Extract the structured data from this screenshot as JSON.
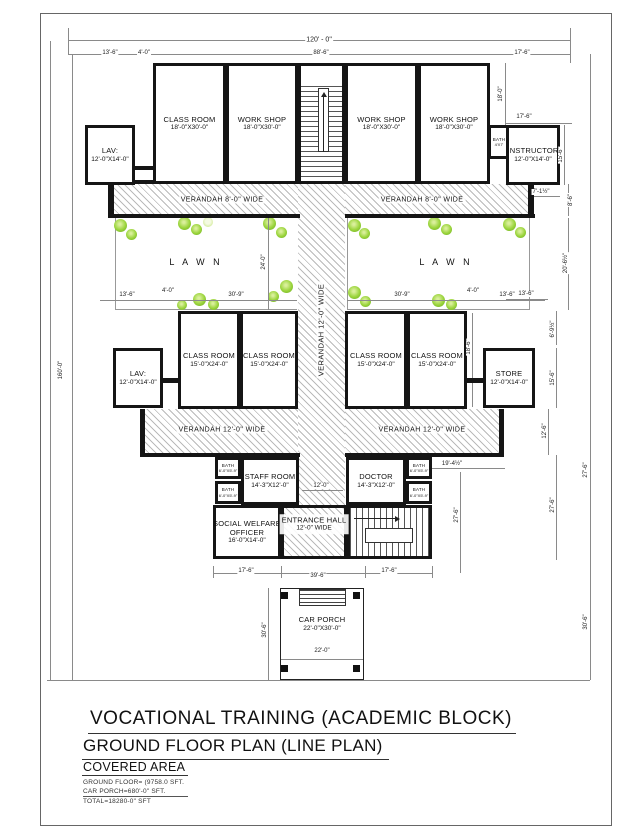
{
  "sheet": {
    "title_line1": "VOCATIONAL TRAINING   (ACADEMIC BLOCK)",
    "title_line2": "GROUND FLOOR PLAN   (LINE PLAN)",
    "covered_area": {
      "heading": "COVERED AREA",
      "line1": "GROUND FLOOR= (9758.0 SFT.",
      "line2": "CAR PORCH=680'-0\" SFT.",
      "line3": "TOTAL=18280-0\" SFT"
    }
  },
  "rooms": {
    "lav_top": {
      "name": "LAV:",
      "size": "12'-0\"X14'-0\""
    },
    "class_top": {
      "name": "CLASS ROOM",
      "size": "18'-0\"X30'-0\""
    },
    "workshop1": {
      "name": "WORK SHOP",
      "size": "18'-0\"X30'-0\""
    },
    "workshop2": {
      "name": "WORK SHOP",
      "size": "18'-0\"X30'-0\""
    },
    "workshop3": {
      "name": "WORK SHOP",
      "size": "18'-0\"X30'-0\""
    },
    "bath_top": {
      "name": "BATH",
      "size": "4'X7'"
    },
    "instructor": {
      "name": "INSTRUCTOR",
      "size": "12'-0\"X14'-0\""
    },
    "lav_mid": {
      "name": "LAV:",
      "size": "12'-0\"X14'-0\""
    },
    "class_mid1": {
      "name": "CLASS ROOM",
      "size": "15'-0\"X24'-0\""
    },
    "class_mid2": {
      "name": "CLASS ROOM",
      "size": "15'-0\"X24'-0\""
    },
    "class_mid3": {
      "name": "CLASS ROOM",
      "size": "15'-0\"X24'-0\""
    },
    "class_mid4": {
      "name": "CLASS ROOM",
      "size": "15'-0\"X24'-0\""
    },
    "store": {
      "name": "STORE",
      "size": "12'-0\"X14'-0\""
    },
    "bath_small": {
      "name": "BATH",
      "size": "6'-0\"X5'-9\""
    },
    "staff": {
      "name": "STAFF ROOM",
      "size": "14'-3\"X12'-0\""
    },
    "doctor": {
      "name": "DOCTOR",
      "size": "14'-3\"X12'-0\""
    },
    "social": {
      "name": "SOCIAL WELFARE",
      "name2": "OFFICER",
      "size": "16'-0\"X14'-0\""
    },
    "entrance": {
      "name": "ENTRANCE HALL",
      "size": "12'-0\" WIDE"
    },
    "car_porch": {
      "name": "CAR PORCH",
      "size": "22'-0\"X30'-0\""
    }
  },
  "areas": {
    "lawn": "L A W N",
    "verandah8": "VERANDAH 8'-0\" WIDE",
    "verandah12": "VERANDAH 12'-0\" WIDE"
  },
  "dims": {
    "overall_width": "120' - 0\"",
    "top_13_6": "13'-6\"",
    "top_4_0": "4'-0\"",
    "top_88_6": "88'-6\"",
    "top_17_6": "17'-6\"",
    "left_height": "160'-0\"",
    "right_18_0": "18'-0\"",
    "instr_17_6": "17'-6\"",
    "instr_15_6": "15'-6\"",
    "r_7_1": "7'-1½\"",
    "r_8_6": "8'-6\"",
    "r_20_6": "20'-6½\"",
    "r_13_6": "13'-6\"",
    "lawn_24": "24'-0\"",
    "lawnl_13_6": "13'-6\"",
    "lawnl_4_0": "4'-0\"",
    "lawnl_30_9": "30'-9\"",
    "lawnr_30_9": "30'-9\"",
    "lawnr_4_0": "4'-0\"",
    "lawnr_13_6": "13'-6\"",
    "mid_18_6": "18'-6\"",
    "r_6_9": "6'-9½\"",
    "store_15_6": "15'-6\"",
    "r_12_6": "12'-6\"",
    "hall_12_0": "12'-0\"",
    "r_19_4": "19'-4½\"",
    "wing_27_6": "27'-6\"",
    "bot_17_6": "17'-6\"",
    "bot_39_6": "39'-6\"",
    "porch_30_6": "30'-6\"",
    "porch_22_0": "22'-0\"",
    "far_27_6": "27'-6\"",
    "far_30_6": "30'-6\""
  }
}
